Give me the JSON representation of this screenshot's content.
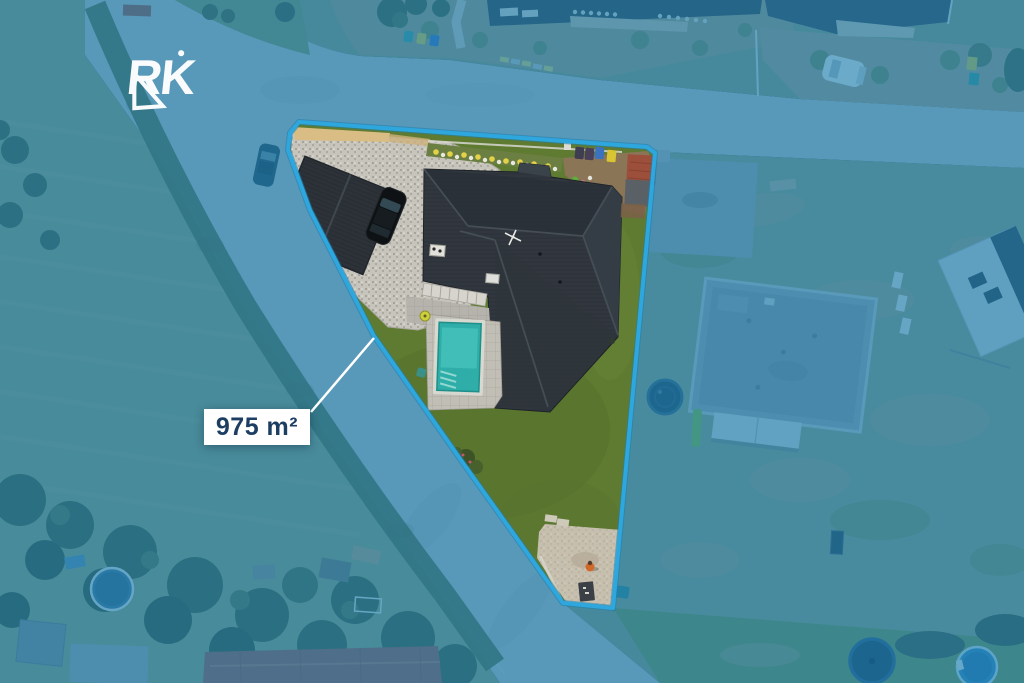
{
  "watermark": {
    "text": "RK"
  },
  "plot": {
    "area_label": "975 m²",
    "area_value": 975,
    "area_unit": "m²"
  },
  "colors": {
    "boundary": "#2ea7de",
    "outside_tint": "#2090cc",
    "tint_deep": "#0b4d66",
    "label_background": "#ffffff",
    "label_text": "#1d3e63",
    "watermark": "#ffffff",
    "pool_water": "#2faea9",
    "lawn": "#5e7b31",
    "house_roof": "#31373e",
    "leader_line": "#ffffff"
  },
  "scene": {
    "type": "aerial-drone-photo",
    "subject": "residential corner plot with house, garage, swimming pool, gravel driveway and lawn",
    "highlight": "plot outlined in light-blue, surroundings masked with blue tint"
  }
}
